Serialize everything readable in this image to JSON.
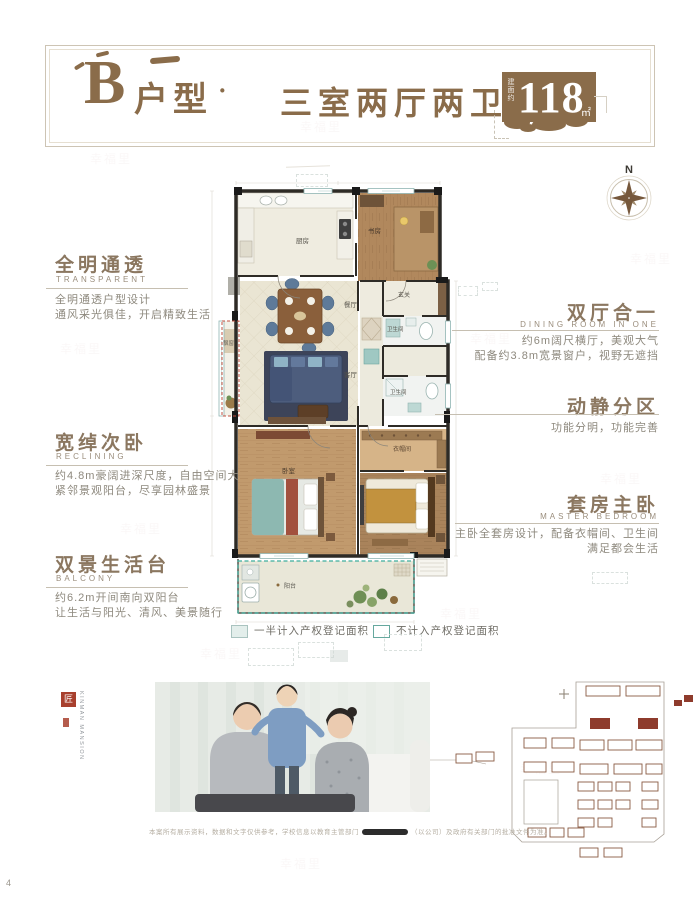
{
  "page": {
    "watermark_text": "幸福里",
    "corner_mark": "4"
  },
  "header": {
    "unit_letter": "B",
    "unit_suffix": "户型",
    "separator": "·",
    "layout": "三室两厅两卫",
    "area_prefix": "建面约",
    "area_value": "118",
    "area_unit": "㎡"
  },
  "compass": {
    "label": "N"
  },
  "floorplan": {
    "rooms": {
      "kitchen": "厨房",
      "study": "书房",
      "entry": "玄关",
      "bath_upper": "卫生间",
      "dining": "餐厅",
      "living": "客厅",
      "bay_window": "飘窗",
      "bath_lower": "卫生间",
      "cloakroom": "衣帽间",
      "bedroom": "卧室",
      "balcony": "阳台"
    }
  },
  "annotations": {
    "left": [
      {
        "title": "全明通透",
        "subtitle": "TRANSPARENT",
        "line1": "全明通透户型设计",
        "line2": "通风采光俱佳，开启精致生活"
      },
      {
        "title": "宽绰次卧",
        "subtitle": "RECLINING",
        "line1": "约4.8m豪阔进深尺度，自由空间大",
        "line2": "紧邻景观阳台，尽享园林盛景"
      },
      {
        "title": "双景生活台",
        "subtitle": "BALCONY",
        "line1": "约6.2m开间南向双阳台",
        "line2": "让生活与阳光、清风、美景随行"
      }
    ],
    "right": [
      {
        "title": "双厅合一",
        "subtitle": "DINING ROOM IN ONE",
        "line1": "约6m阔尺横厅，美观大气",
        "line2": "配备约3.8m宽景窗户，视野无遮挡"
      },
      {
        "title": "动静分区",
        "subtitle": "",
        "line1": "功能分明，功能完善",
        "line2": ""
      },
      {
        "title": "套房主卧",
        "subtitle": "MASTER BEDROOM",
        "line1": "主卧全套房设计，配备衣帽间、卫生间",
        "line2": "满足都会生活"
      }
    ]
  },
  "legend": {
    "half_counted": "一半计入产权登记面积",
    "not_counted": "不计入产权登记面积"
  },
  "brand": {
    "seal_char": "匠",
    "name_vertical": "KINMAN MANSION"
  },
  "disclaimer": {
    "part1": "本案所有展示资料，数据和文字仅供参考，学校信息以教育主管部门",
    "part2": "（以公司）及政府有关部门的批准文件为准。"
  },
  "colors": {
    "brand_brown": "#8a6c4a",
    "legend_teal": "#66a89e",
    "bay_red": "#c05040",
    "site_red": "#8e3b2c"
  }
}
